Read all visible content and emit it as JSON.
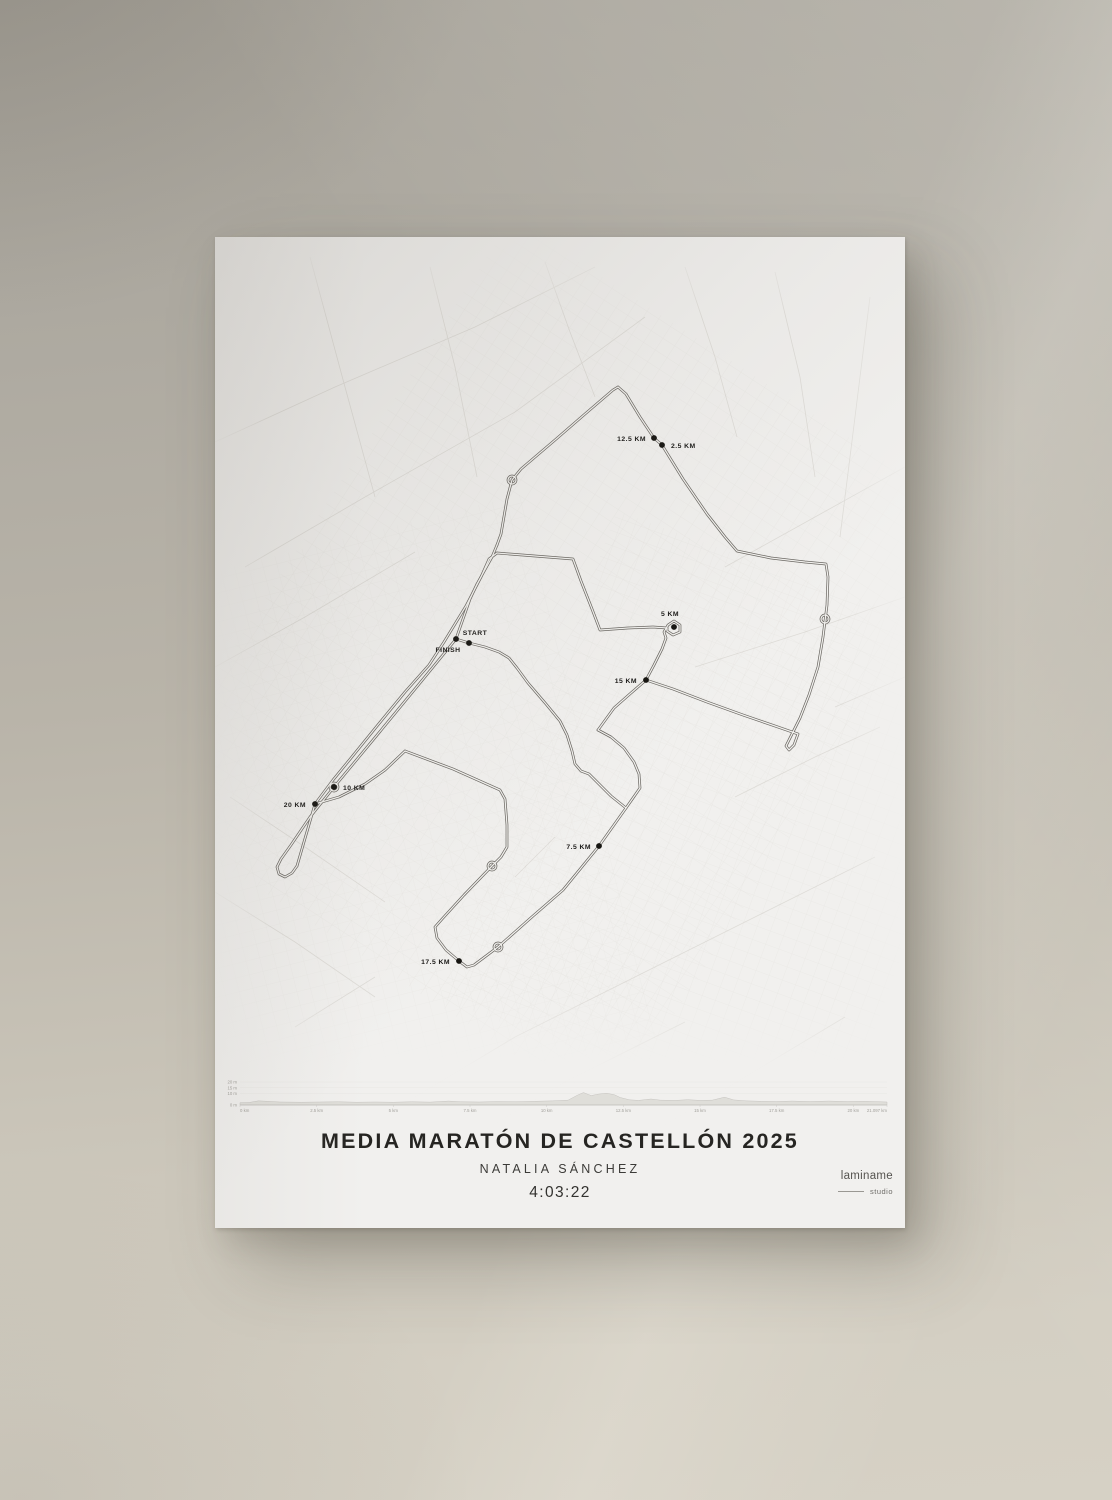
{
  "poster": {
    "title": "MEDIA MARATÓN DE CASTELLÓN 2025",
    "subtitle": "NATALIA SÁNCHEZ",
    "time": "4:03:22",
    "brand": {
      "name": "laminame",
      "sub": "studio"
    }
  },
  "map": {
    "route_color": "#6a6762",
    "route_inner_color": "#f2f1ee",
    "marker_dot_color": "#161511",
    "markers": [
      {
        "label": "START",
        "x": 254,
        "y": 406,
        "anchor": "middle",
        "dx": 6,
        "dy": -8
      },
      {
        "label": "FINISH",
        "x": 241,
        "y": 402,
        "anchor": "middle",
        "dx": -8,
        "dy": 13
      },
      {
        "label": "2.5 KM",
        "x": 447,
        "y": 208,
        "anchor": "start",
        "dx": 9,
        "dy": 3
      },
      {
        "label": "5 KM",
        "x": 459,
        "y": 390,
        "anchor": "middle",
        "dx": -4,
        "dy": -11
      },
      {
        "label": "7.5 KM",
        "x": 384,
        "y": 609,
        "anchor": "end",
        "dx": -8,
        "dy": 3
      },
      {
        "label": "10 KM",
        "x": 119,
        "y": 550,
        "anchor": "start",
        "dx": 9,
        "dy": 3
      },
      {
        "label": "12.5 KM",
        "x": 439,
        "y": 201,
        "anchor": "end",
        "dx": -8,
        "dy": 3
      },
      {
        "label": "15 KM",
        "x": 431,
        "y": 443,
        "anchor": "end",
        "dx": -9,
        "dy": 3
      },
      {
        "label": "17.5 KM",
        "x": 244,
        "y": 724,
        "anchor": "end",
        "dx": -9,
        "dy": 3
      },
      {
        "label": "20 KM",
        "x": 100,
        "y": 567,
        "anchor": "end",
        "dx": -9,
        "dy": 3
      }
    ],
    "roundabouts": [
      [
        297,
        243
      ],
      [
        119,
        550
      ],
      [
        277,
        629
      ],
      [
        283,
        710
      ],
      [
        610,
        382
      ]
    ],
    "route_segments": [
      [
        [
          282,
          308
        ],
        [
          277,
          320
        ],
        [
          262,
          347
        ],
        [
          255,
          362
        ],
        [
          241,
          402
        ],
        [
          200,
          452
        ],
        [
          158,
          503
        ],
        [
          119,
          550
        ],
        [
          95,
          580
        ],
        [
          76,
          608
        ],
        [
          66,
          622
        ],
        [
          62,
          630
        ],
        [
          64,
          637
        ],
        [
          70,
          640
        ],
        [
          77,
          636
        ],
        [
          82,
          629
        ]
      ],
      [
        [
          82,
          629
        ],
        [
          100,
          567
        ],
        [
          118,
          543
        ],
        [
          136,
          521
        ],
        [
          162,
          489
        ],
        [
          190,
          455
        ],
        [
          214,
          428
        ],
        [
          229,
          405
        ],
        [
          251,
          369
        ],
        [
          266,
          340
        ],
        [
          274,
          322
        ],
        [
          282,
          316
        ]
      ],
      [
        [
          190,
          514
        ],
        [
          170,
          533
        ],
        [
          150,
          547
        ],
        [
          124,
          560
        ],
        [
          100,
          567
        ]
      ],
      [
        [
          282,
          308
        ],
        [
          286,
          297
        ],
        [
          292,
          262
        ],
        [
          297,
          243
        ],
        [
          306,
          232
        ],
        [
          340,
          203
        ],
        [
          370,
          177
        ],
        [
          398,
          153
        ],
        [
          403,
          150
        ]
      ],
      [
        [
          403,
          150
        ],
        [
          411,
          157
        ],
        [
          425,
          180
        ],
        [
          439,
          201
        ],
        [
          447,
          208
        ],
        [
          468,
          242
        ],
        [
          492,
          277
        ],
        [
          510,
          300
        ],
        [
          522,
          314
        ],
        [
          556,
          321
        ],
        [
          590,
          325
        ],
        [
          611,
          327
        ],
        [
          613,
          340
        ],
        [
          612,
          368
        ],
        [
          608,
          400
        ],
        [
          603,
          430
        ],
        [
          594,
          458
        ],
        [
          585,
          481
        ],
        [
          579,
          493
        ],
        [
          574,
          503
        ],
        [
          571,
          509
        ],
        [
          574,
          513
        ],
        [
          579,
          508
        ],
        [
          583,
          497
        ],
        [
          560,
          489
        ],
        [
          528,
          478
        ],
        [
          492,
          465
        ],
        [
          458,
          452
        ],
        [
          431,
          443
        ]
      ],
      [
        [
          282,
          316
        ],
        [
          320,
          319
        ],
        [
          358,
          322
        ],
        [
          366,
          344
        ],
        [
          377,
          372
        ],
        [
          385,
          393
        ],
        [
          413,
          391
        ],
        [
          438,
          390
        ],
        [
          452,
          391
        ]
      ],
      [
        [
          431,
          443
        ],
        [
          439,
          428
        ],
        [
          447,
          412
        ],
        [
          451,
          401
        ],
        [
          449,
          395
        ],
        [
          453,
          388
        ],
        [
          459,
          384
        ],
        [
          465,
          388
        ],
        [
          465,
          395
        ],
        [
          458,
          398
        ],
        [
          452,
          394
        ],
        [
          452,
          391
        ]
      ],
      [
        [
          190,
          514
        ],
        [
          238,
          532
        ],
        [
          285,
          553
        ],
        [
          290,
          562
        ],
        [
          292,
          588
        ],
        [
          292,
          610
        ],
        [
          286,
          620
        ],
        [
          277,
          629
        ],
        [
          249,
          658
        ],
        [
          228,
          681
        ],
        [
          220,
          690
        ],
        [
          222,
          701
        ],
        [
          231,
          713
        ],
        [
          244,
          724
        ],
        [
          252,
          730
        ],
        [
          259,
          728
        ],
        [
          271,
          719
        ],
        [
          283,
          710
        ],
        [
          318,
          679
        ],
        [
          348,
          653
        ],
        [
          384,
          609
        ],
        [
          411,
          571
        ],
        [
          425,
          551
        ],
        [
          424,
          537
        ],
        [
          419,
          525
        ],
        [
          409,
          511
        ],
        [
          396,
          500
        ],
        [
          383,
          493
        ]
      ],
      [
        [
          431,
          443
        ],
        [
          416,
          456
        ],
        [
          399,
          471
        ],
        [
          383,
          493
        ]
      ],
      [
        [
          241,
          402
        ],
        [
          254,
          406
        ],
        [
          270,
          410
        ],
        [
          284,
          415
        ],
        [
          294,
          421
        ],
        [
          302,
          431
        ],
        [
          313,
          446
        ],
        [
          331,
          467
        ],
        [
          345,
          484
        ],
        [
          352,
          498
        ],
        [
          357,
          514
        ],
        [
          360,
          527
        ],
        [
          366,
          534
        ],
        [
          374,
          537
        ],
        [
          384,
          547
        ],
        [
          396,
          559
        ],
        [
          411,
          571
        ]
      ]
    ]
  },
  "chart_data": {
    "type": "area",
    "title": "",
    "xlabel": "",
    "ylabel": "",
    "x_range": [
      0,
      21.097
    ],
    "y_range": [
      0,
      20
    ],
    "x_ticks": [
      "0 km",
      "2.5 km",
      "5 km",
      "7.5 km",
      "10 km",
      "12.5 km",
      "15 km",
      "17.5 km",
      "20 km",
      "21.097 km"
    ],
    "x_tick_values": [
      0,
      2.5,
      5,
      7.5,
      10,
      12.5,
      15,
      17.5,
      20,
      21.097
    ],
    "y_ticks": [
      "20 m",
      "15 m",
      "10 m",
      "0 m"
    ],
    "y_tick_values": [
      20,
      15,
      10,
      0
    ],
    "grid": true,
    "legend": false,
    "series": [
      {
        "name": "elevation",
        "x": [
          0,
          0.3,
          0.6,
          0.9,
          1.3,
          2,
          2.6,
          3.2,
          3.8,
          4.4,
          5,
          5.6,
          6.2,
          6.8,
          7.2,
          7.8,
          8.4,
          9,
          9.6,
          10.2,
          10.7,
          11,
          11.2,
          11.45,
          11.7,
          11.95,
          12.2,
          12.4,
          12.7,
          13,
          13.4,
          13.7,
          14.2,
          14.6,
          15,
          15.4,
          15.8,
          16.1,
          16.5,
          17,
          17.5,
          18,
          18.6,
          19.2,
          19.8,
          20.4,
          21.097
        ],
        "y": [
          2,
          2.2,
          3.6,
          3.2,
          2.6,
          2.4,
          2.6,
          2.8,
          2.4,
          2.6,
          2.4,
          2.8,
          2.5,
          3.4,
          2.8,
          2.6,
          3,
          2.8,
          3.2,
          3.6,
          4.2,
          8.5,
          10.8,
          8.2,
          9.5,
          10.2,
          9,
          6.5,
          4.5,
          4,
          5.2,
          4.2,
          4,
          4.6,
          4,
          4.2,
          6.8,
          4.4,
          3.6,
          3.2,
          3,
          3.4,
          3,
          3.4,
          3,
          3.2,
          2.6
        ]
      }
    ]
  }
}
